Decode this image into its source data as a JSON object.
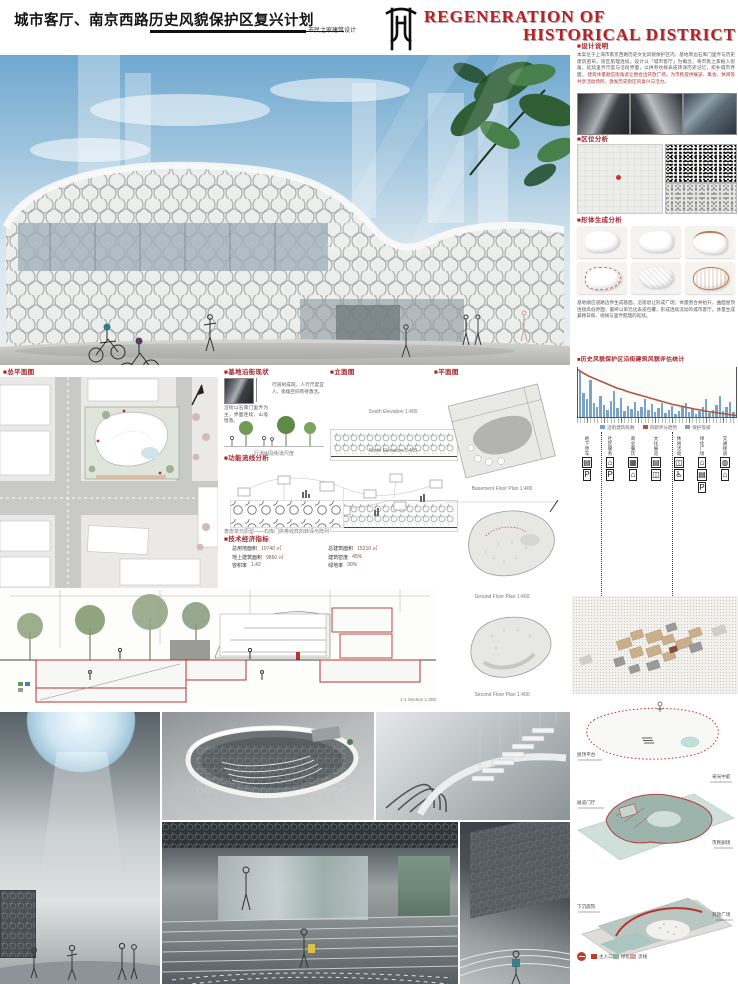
{
  "accent": {
    "red": "#a3242a",
    "teal": "#a9c6c0",
    "bar_blue": "#7aa3c9",
    "line_red": "#b0563e"
  },
  "header": {
    "title_cn": "城市客厅、南京西路历史风貌保护区复兴计划",
    "subtitle_cn": "市民之家建筑设计",
    "title_en_line1": "REGENERATION OF",
    "title_en_line2": "HISTORICAL DISTRICT"
  },
  "design": {
    "header": "■设计说明",
    "body": "本案位于上海市南京西路历史文化风貌保护区内，基地周边石库门里弄与历史建筑密布，街区肌理连续。设计以「城市客厅」为概念，将市民之家植入街角，延续里弄尺度与沿街界面，以拱券纹样表皮转译历史记忆，织补城市界面。",
    "body2": "建筑体量顺应街角退让围合出开放广场，为市民提供展览、集会、休闲等共享活动场所，激发历史街区的复兴与活力。"
  },
  "location": {
    "header": "■区位分析"
  },
  "massing": {
    "header": "■形体生成分析",
    "body": "基地顺应道路边界生成基面，沿街退让形成广场；体量围合并抬升，曲面屋顶连接高低界面；最终以单元化表皮包覆，形成连续流动的城市客厅。体量生成兼顾日照、视线与里弄肌理的延续。"
  },
  "stats": {
    "header": "■历史风貌保护区沿街建筑风貌评估统计",
    "legend": [
      {
        "color": "#7aa3c9",
        "label": "沿街建筑栋数"
      },
      {
        "color": "#b0563e",
        "label": "风貌评分趋势"
      },
      {
        "color": "#9a9a9a",
        "label": "保护等级"
      }
    ]
  },
  "chart_data": {
    "type": "bar",
    "title": "历史风貌保护区沿街建筑风貌评估统计",
    "xlabel": "沿街建筑编号",
    "ylabel": "栋数 / 评分",
    "ymax": 60,
    "bars": [
      58,
      30,
      22,
      46,
      18,
      12,
      26,
      15,
      9,
      20,
      33,
      11,
      24,
      8,
      14,
      10,
      19,
      7,
      13,
      23,
      9,
      16,
      6,
      11,
      18,
      5,
      9,
      14,
      4,
      8,
      12,
      17,
      6,
      10,
      4,
      7,
      12,
      22,
      5,
      9,
      15,
      26,
      8,
      13,
      19,
      6
    ],
    "line": [
      95,
      90,
      86,
      82,
      79,
      76,
      73,
      70,
      67,
      64,
      61,
      58,
      56,
      54,
      51,
      49,
      47,
      45,
      43,
      41,
      39,
      37,
      35,
      33,
      31,
      29,
      27,
      25,
      24,
      22,
      21,
      19,
      18,
      16,
      15,
      14,
      12,
      11,
      10,
      9,
      8,
      7,
      6,
      5,
      4,
      3
    ],
    "legend_position": "bottom",
    "grid": false
  },
  "timeline": {
    "columns": [
      {
        "glyphs": "▤P",
        "label": "地下停车"
      },
      {
        "glyphs": "⌂P",
        "label": "社区服务"
      },
      {
        "glyphs": "▦⌂",
        "label": "商业餐饮"
      },
      {
        "glyphs": "▤◫",
        "label": "文化展览"
      },
      {
        "glyphs": "◫♿",
        "label": "休闲活动"
      },
      {
        "glyphs": "⌂▤P",
        "label": "绿化广场"
      },
      {
        "glyphs": "◍⌂",
        "label": "交通接驳"
      }
    ]
  },
  "axon": {
    "labels_left": [
      "屋顶平台",
      "展览门厅",
      "下沉庭院"
    ],
    "labels_right": [
      "采光中庭",
      "市民剧场",
      "开放广场"
    ],
    "legend": [
      {
        "color": "#c0392b",
        "label": "主入口"
      },
      {
        "color": "#8db596",
        "label": "绿化"
      },
      {
        "color": "#d3a7ab",
        "label": "流线"
      }
    ]
  },
  "siteplan": {
    "header": "■总平面图"
  },
  "street": {
    "header": "■基地沿街现状",
    "body": "沿街以石库门里弄为主，界面连续，山墙错落。",
    "body2": "行道树成荫，人行尺度宜人，街角空间有待激活。",
    "cap1": "沿街界面现状",
    "cap2": "行道树及街道尺度"
  },
  "elev": {
    "header": "■立面图",
    "cap1": "South Elevation 1:400",
    "cap2": "North Elevation 1:400"
  },
  "bubble": {
    "header": "■功能流线分析",
    "caption": "表皮单元原型——石库门拱券纹样的转译与阵列"
  },
  "indicators": {
    "header": "■技术经济指标",
    "rows": [
      {
        "k": "总用地面积",
        "v": "10740 ㎡"
      },
      {
        "k": "总建筑面积",
        "v": "15210 ㎡"
      },
      {
        "k": "地上建筑面积",
        "v": "9860 ㎡"
      },
      {
        "k": "建筑密度",
        "v": "45%"
      },
      {
        "k": "容积率",
        "v": "1.42"
      },
      {
        "k": "绿地率",
        "v": "30%"
      }
    ]
  },
  "plans": {
    "header": "■平面图",
    "captions": [
      "Basement Floor Plan 1:400",
      "Ground Floor Plan 1:400",
      "Second Floor Plan 1:400"
    ]
  },
  "section": {
    "caption": "1-1 Section 1:300",
    "legend": [
      "绿化",
      "水体"
    ]
  }
}
